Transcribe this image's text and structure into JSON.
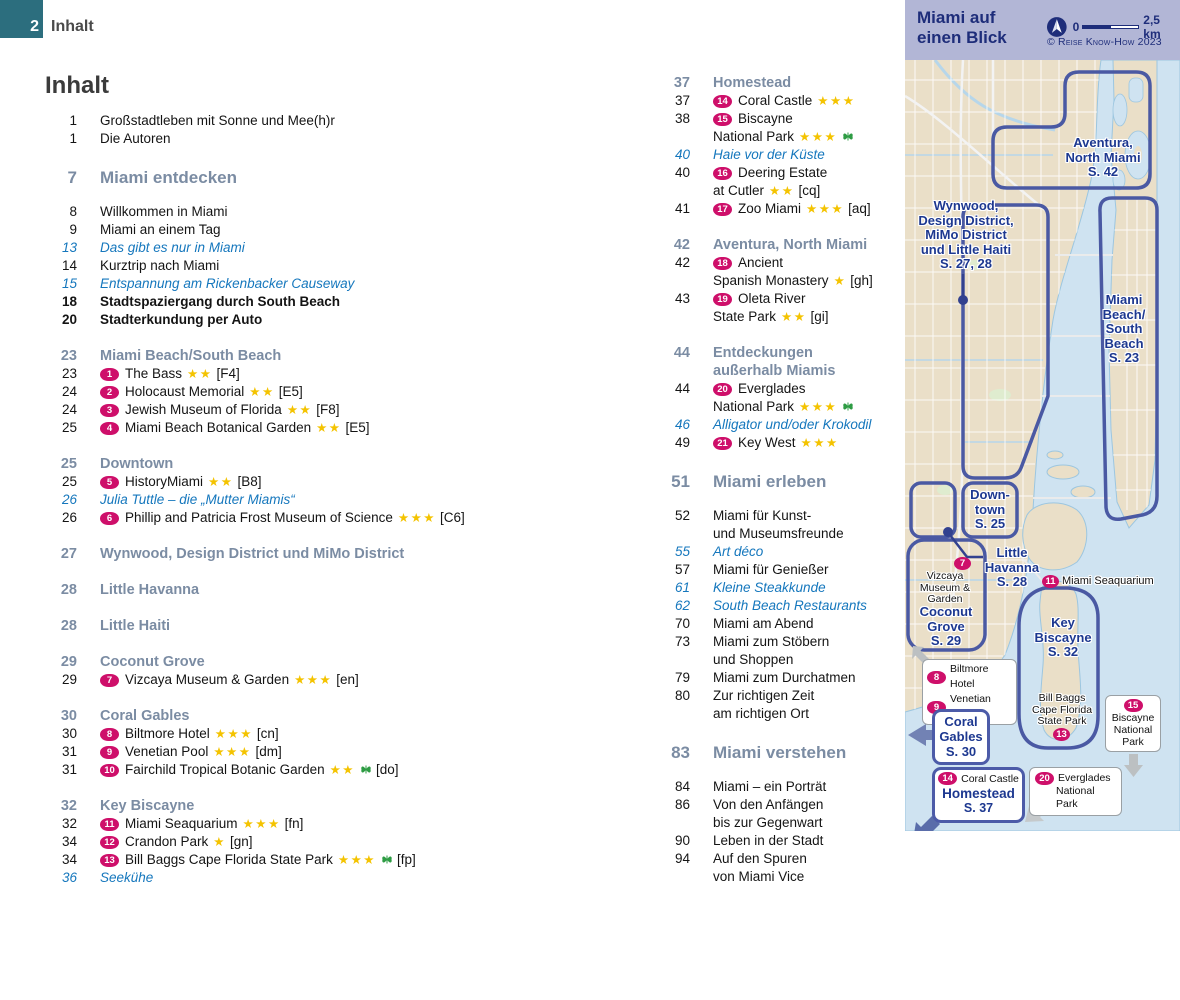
{
  "page_header": {
    "page_number": "2",
    "label": "Inhalt"
  },
  "title": "Inhalt",
  "colors": {
    "accent_teal": "#2c6e7e",
    "badge_pink": "#ce0f6a",
    "star_gold": "#f4c300",
    "italic_blue": "#1577bd",
    "section_slate": "#7b8ca3",
    "map_navy": "#1d3890",
    "map_land": "#eadfc8",
    "map_water": "#cfe3f1",
    "panel_lavender": "#b2b6d6"
  },
  "toc": {
    "left": [
      {
        "t": "item",
        "page": "1",
        "text": "Großstadtleben mit Sonne und Mee(h)r"
      },
      {
        "t": "item",
        "page": "1",
        "text": "Die Autoren"
      },
      {
        "t": "chapter",
        "page": "7",
        "text": "Miami entdecken"
      },
      {
        "t": "item",
        "page": "8",
        "text": "Willkommen in Miami"
      },
      {
        "t": "item",
        "page": "9",
        "text": "Miami an einem Tag"
      },
      {
        "t": "italic",
        "page": "13",
        "text": "Das gibt es nur in Miami"
      },
      {
        "t": "item",
        "page": "14",
        "text": "Kurztrip nach Miami"
      },
      {
        "t": "italic",
        "page": "15",
        "text": "Entspannung am Rickenbacker Causeway"
      },
      {
        "t": "bold",
        "page": "18",
        "text": "Stadtspaziergang durch South Beach"
      },
      {
        "t": "bold",
        "page": "20",
        "text": "Stadterkundung per Auto"
      },
      {
        "t": "section",
        "page": "23",
        "text": "Miami Beach/South Beach"
      },
      {
        "t": "item",
        "page": "23",
        "badge": "1",
        "text": "The Bass",
        "stars": 2,
        "ref": "[F4]"
      },
      {
        "t": "item",
        "page": "24",
        "badge": "2",
        "text": "Holocaust Memorial",
        "stars": 2,
        "ref": "[E5]"
      },
      {
        "t": "item",
        "page": "24",
        "badge": "3",
        "text": "Jewish Museum of Florida",
        "stars": 2,
        "ref": "[F8]"
      },
      {
        "t": "item",
        "page": "25",
        "badge": "4",
        "text": "Miami Beach Botanical Garden",
        "stars": 2,
        "ref": "[E5]"
      },
      {
        "t": "section",
        "page": "25",
        "text": "Downtown"
      },
      {
        "t": "item",
        "page": "25",
        "badge": "5",
        "text": "HistoryMiami",
        "stars": 2,
        "ref": "[B8]"
      },
      {
        "t": "italic",
        "page": "26",
        "text": "Julia Tuttle – die „Mutter Miamis“"
      },
      {
        "t": "item",
        "page": "26",
        "badge": "6",
        "text": "Phillip and Patricia Frost Museum of Science",
        "stars": 3,
        "ref": "[C6]"
      },
      {
        "t": "section",
        "page": "27",
        "text": "Wynwood, Design District und MiMo District"
      },
      {
        "t": "section",
        "page": "28",
        "text": "Little Havanna"
      },
      {
        "t": "section",
        "page": "28",
        "text": "Little Haiti"
      },
      {
        "t": "section",
        "page": "29",
        "text": "Coconut Grove"
      },
      {
        "t": "item",
        "page": "29",
        "badge": "7",
        "text": "Vizcaya Museum & Garden",
        "stars": 3,
        "ref": "[en]"
      },
      {
        "t": "section",
        "page": "30",
        "text": "Coral Gables"
      },
      {
        "t": "item",
        "page": "30",
        "badge": "8",
        "text": "Biltmore Hotel",
        "stars": 3,
        "ref": "[cn]"
      },
      {
        "t": "item",
        "page": "31",
        "badge": "9",
        "text": "Venetian Pool",
        "stars": 3,
        "ref": "[dm]"
      },
      {
        "t": "item",
        "page": "31",
        "badge": "10",
        "text": "Fairchild Tropical Botanic Garden",
        "stars": 2,
        "nature": true,
        "ref": "[do]"
      },
      {
        "t": "section",
        "page": "32",
        "text": "Key Biscayne"
      },
      {
        "t": "item",
        "page": "32",
        "badge": "11",
        "text": "Miami Seaquarium",
        "stars": 3,
        "ref": "[fn]"
      },
      {
        "t": "item",
        "page": "34",
        "badge": "12",
        "text": "Crandon Park",
        "stars": 1,
        "ref": "[gn]"
      },
      {
        "t": "item",
        "page": "34",
        "badge": "13",
        "text": "Bill Baggs Cape Florida State Park",
        "stars": 3,
        "nature": true,
        "ref": "[fp]"
      },
      {
        "t": "italic",
        "page": "36",
        "text": "Seekühe"
      }
    ],
    "right": [
      {
        "t": "section",
        "page": "37",
        "text": "Homestead"
      },
      {
        "t": "item",
        "page": "37",
        "badge": "14",
        "text": "Coral Castle",
        "stars": 3
      },
      {
        "t": "item",
        "page": "38",
        "badge": "15",
        "text": "Biscayne"
      },
      {
        "t": "cont",
        "text": "National Park",
        "stars": 3,
        "nature": true
      },
      {
        "t": "italic",
        "page": "40",
        "text": "Haie vor der Küste"
      },
      {
        "t": "item",
        "page": "40",
        "badge": "16",
        "text": "Deering Estate"
      },
      {
        "t": "cont",
        "text": "at Cutler",
        "stars": 2,
        "ref": "[cq]"
      },
      {
        "t": "item",
        "page": "41",
        "badge": "17",
        "text": "Zoo Miami",
        "stars": 3,
        "ref": "[aq]"
      },
      {
        "t": "section",
        "page": "42",
        "text": "Aventura, North Miami"
      },
      {
        "t": "item",
        "page": "42",
        "badge": "18",
        "text": "Ancient"
      },
      {
        "t": "cont",
        "text": "Spanish Monastery",
        "stars": 1,
        "ref": "[gh]"
      },
      {
        "t": "item",
        "page": "43",
        "badge": "19",
        "text": "Oleta River"
      },
      {
        "t": "cont",
        "text": "State Park",
        "stars": 2,
        "ref": "[gi]"
      },
      {
        "t": "section",
        "page": "44",
        "text": "Entdeckungen"
      },
      {
        "t": "section-cont",
        "text": "außerhalb Miamis"
      },
      {
        "t": "item",
        "page": "44",
        "badge": "20",
        "text": "Everglades"
      },
      {
        "t": "cont",
        "text": "National Park",
        "stars": 3,
        "nature": true
      },
      {
        "t": "italic",
        "page": "46",
        "text": "Alligator und/oder Krokodil"
      },
      {
        "t": "item",
        "page": "49",
        "badge": "21",
        "text": "Key West",
        "stars": 3
      },
      {
        "t": "chapter",
        "page": "51",
        "text": "Miami erleben"
      },
      {
        "t": "item",
        "page": "52",
        "text": "Miami für Kunst-"
      },
      {
        "t": "cont",
        "text": "und Museumsfreunde"
      },
      {
        "t": "italic",
        "page": "55",
        "text": "Art déco"
      },
      {
        "t": "item",
        "page": "57",
        "text": "Miami für Genießer"
      },
      {
        "t": "italic",
        "page": "61",
        "text": "Kleine Steakkunde"
      },
      {
        "t": "italic",
        "page": "62",
        "text": "South Beach Restaurants"
      },
      {
        "t": "item",
        "page": "70",
        "text": "Miami am Abend"
      },
      {
        "t": "item",
        "page": "73",
        "text": "Miami zum Stöbern"
      },
      {
        "t": "cont",
        "text": "und Shoppen"
      },
      {
        "t": "item",
        "page": "79",
        "text": "Miami zum Durchatmen"
      },
      {
        "t": "item",
        "page": "80",
        "text": "Zur richtigen Zeit"
      },
      {
        "t": "cont",
        "text": "am richtigen Ort"
      },
      {
        "t": "chapter",
        "page": "83",
        "text": "Miami verstehen"
      },
      {
        "t": "item",
        "page": "84",
        "text": "Miami – ein Porträt"
      },
      {
        "t": "item",
        "page": "86",
        "text": "Von den Anfängen"
      },
      {
        "t": "cont",
        "text": "bis zur Gegenwart"
      },
      {
        "t": "item",
        "page": "90",
        "text": "Leben in der Stadt"
      },
      {
        "t": "item",
        "page": "94",
        "text": "Auf den Spuren"
      },
      {
        "t": "cont",
        "text": "von Miami Vice"
      }
    ]
  },
  "map": {
    "panel_title": "Miami auf\neinen Blick",
    "scale_zero": "0",
    "scale_label": "2,5 km",
    "copyright": "© Reise Know-How 2023",
    "labels": {
      "wynwood": "Wynwood,\nDesign District,\nMiMo District\nund Little Haiti\nS. 27, 28",
      "aventura": "Aventura,\nNorth Miami\nS. 42",
      "miami_beach": "Miami\nBeach/\nSouth\nBeach\nS. 23",
      "downtown": "Down-\ntown\nS. 25",
      "little_havanna": "Little\nHavanna\nS. 28",
      "coconut_grove": "Coconut\nGrove\nS. 29",
      "key_biscayne": "Key\nBiscayne\nS. 32",
      "vizcaya": {
        "badge": "7",
        "text": "Vizcaya\nMuseum &\nGarden"
      },
      "seaquarium": {
        "badge": "11",
        "text": "Miami Seaquarium"
      },
      "bill_baggs": {
        "badge": "13",
        "text": "Bill Baggs\nCape Florida\nState Park"
      }
    },
    "callouts": {
      "biltmore": {
        "badge": "8",
        "text": "Biltmore Hotel"
      },
      "venetian": {
        "badge": "9",
        "text": "Venetian Pool"
      },
      "coral_gables": {
        "text": "Coral\nGables\nS. 30"
      },
      "homestead": {
        "badge": "14",
        "line1": "Coral Castle",
        "name": "Homestead",
        "page": "S. 37"
      },
      "biscayne_np": {
        "badge": "15",
        "text": "Biscayne\nNational\nPark"
      },
      "everglades": {
        "badge": "20",
        "line1": "Everglades",
        "line2": "National Park"
      }
    }
  }
}
